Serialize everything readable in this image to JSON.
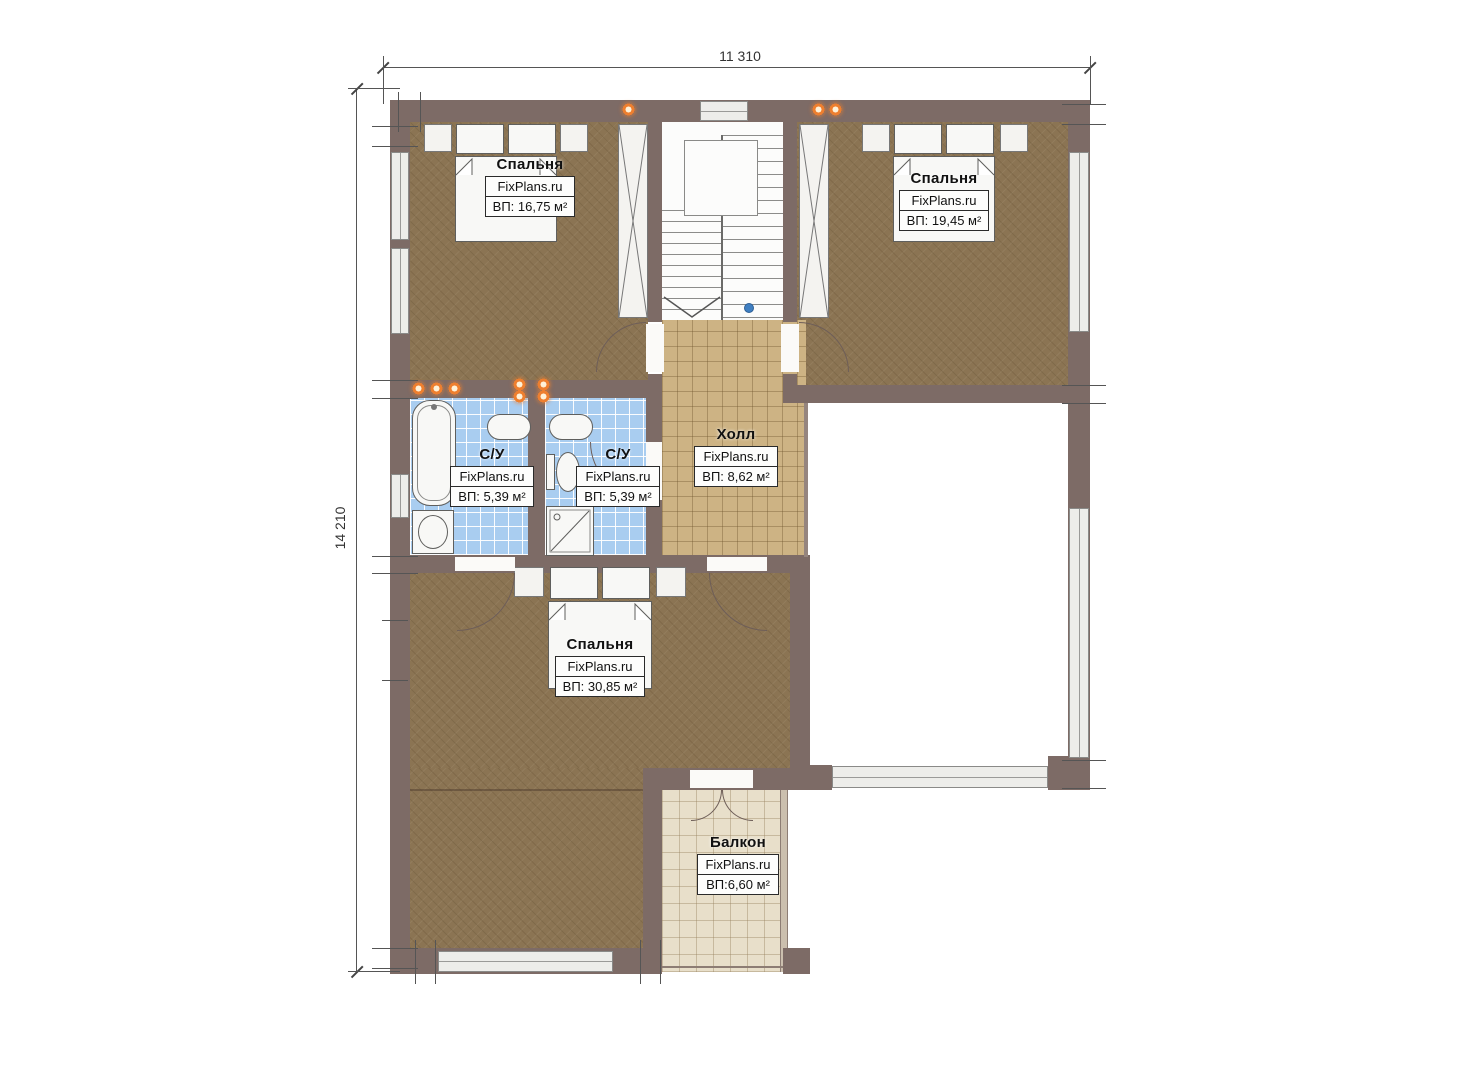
{
  "plan": {
    "type": "floor-plan",
    "brand": "FixPlans.ru",
    "dimensions": {
      "width_label": "11 310",
      "height_label": "14 210"
    },
    "rooms": [
      {
        "name": "Спальня",
        "brand": "FixPlans.ru",
        "area": "ВП: 16,75 м²"
      },
      {
        "name": "Спальня",
        "brand": "FixPlans.ru",
        "area": "ВП: 19,45 м²"
      },
      {
        "name": "С/У",
        "brand": "FixPlans.ru",
        "area": "ВП: 5,39 м²"
      },
      {
        "name": "С/У",
        "brand": "FixPlans.ru",
        "area": "ВП: 5,39 м²"
      },
      {
        "name": "Холл",
        "brand": "FixPlans.ru",
        "area": "ВП: 8,62 м²"
      },
      {
        "name": "Спальня",
        "brand": "FixPlans.ru",
        "area": "ВП: 30,85 м²"
      },
      {
        "name": "Балкон",
        "brand": "FixPlans.ru",
        "area": "ВП:6,60 м²"
      }
    ],
    "colors": {
      "wall": "#7d6b66",
      "wood_floor": "#8b7453",
      "hall_tile": "#cdb384",
      "bath_tile": "#a9cdf0",
      "balcony_floor": "#e8dfca",
      "wall_light": "#ee7f2f",
      "level_mark": "#3f7fc1"
    }
  }
}
